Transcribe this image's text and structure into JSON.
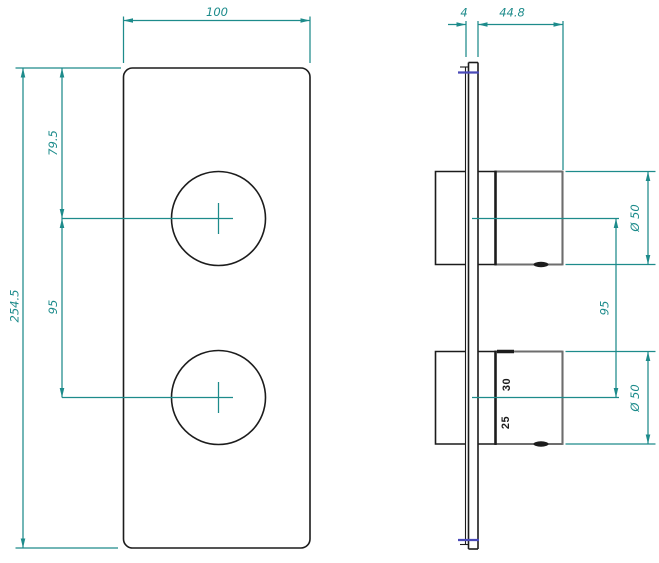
{
  "front": {
    "width": "100",
    "height": "254.5",
    "top_to_upper_knob": "79.5",
    "knob_spacing": "95"
  },
  "side": {
    "plate_thickness": "4",
    "knob_depth": "44.8",
    "upper_knob_diameter": "Ø 50",
    "knob_spacing": "95",
    "lower_knob_diameter": "Ø 50",
    "lower_knob_marks": {
      "upper": "30",
      "lower": "25"
    }
  },
  "colors": {
    "dimension": "#1d8b8b",
    "line-black": "#1c1c1c",
    "line-gray": "#6d6d6d",
    "accent-blue": "#4a4ab8",
    "background": "#ffffff"
  }
}
